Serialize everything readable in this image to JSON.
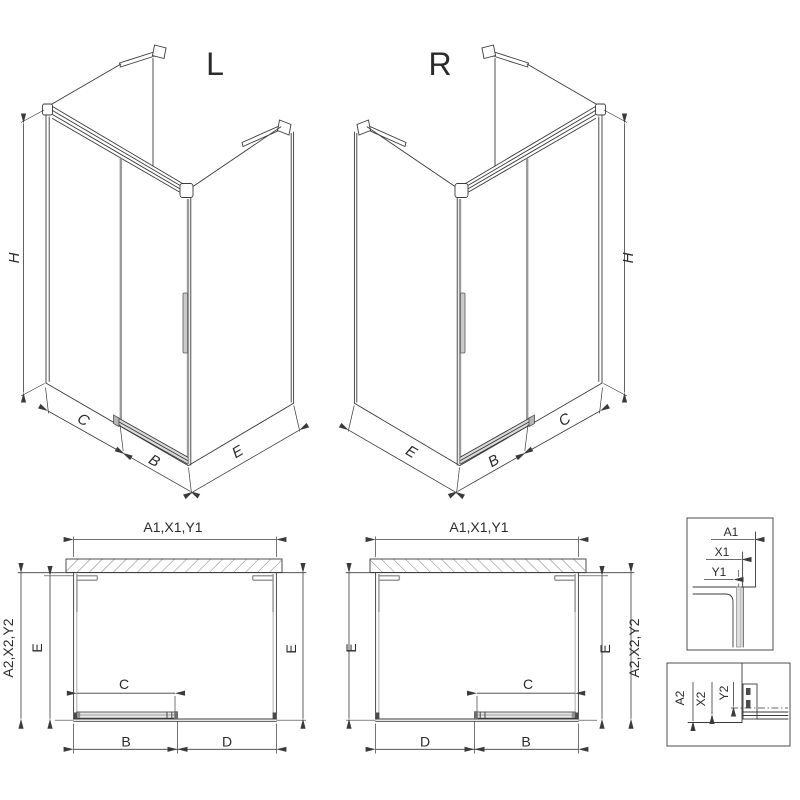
{
  "colors": {
    "line": "#3a3a3a",
    "profile_gray": "#9a9a9a",
    "glass_fill": "#dedede",
    "hatch": "#707070",
    "background": "#ffffff"
  },
  "iso_left": {
    "title": "L",
    "dim_height": "H",
    "dim_fixed": "C",
    "dim_door": "B",
    "dim_side": "E"
  },
  "iso_right": {
    "title": "R",
    "dim_height": "H",
    "dim_fixed": "C",
    "dim_door": "B",
    "dim_side": "E"
  },
  "plan_left": {
    "dim_width": "A1,X1,Y1",
    "dim_depth": "A2,X2,Y2",
    "dim_inner_left": "E",
    "dim_inner_right": "E",
    "dim_opening": "C",
    "dim_door": "B",
    "dim_fixed": "D"
  },
  "plan_right": {
    "dim_width": "A1,X1,Y1",
    "dim_depth": "A2,X2,Y2",
    "dim_inner_left": "E",
    "dim_inner_right": "E",
    "dim_opening": "C",
    "dim_door": "B",
    "dim_fixed": "D"
  },
  "detail_top": {
    "dim_a": "A1",
    "dim_x": "X1",
    "dim_y": "Y1"
  },
  "detail_bottom": {
    "dim_a": "A2",
    "dim_x": "X2",
    "dim_y": "Y2"
  }
}
